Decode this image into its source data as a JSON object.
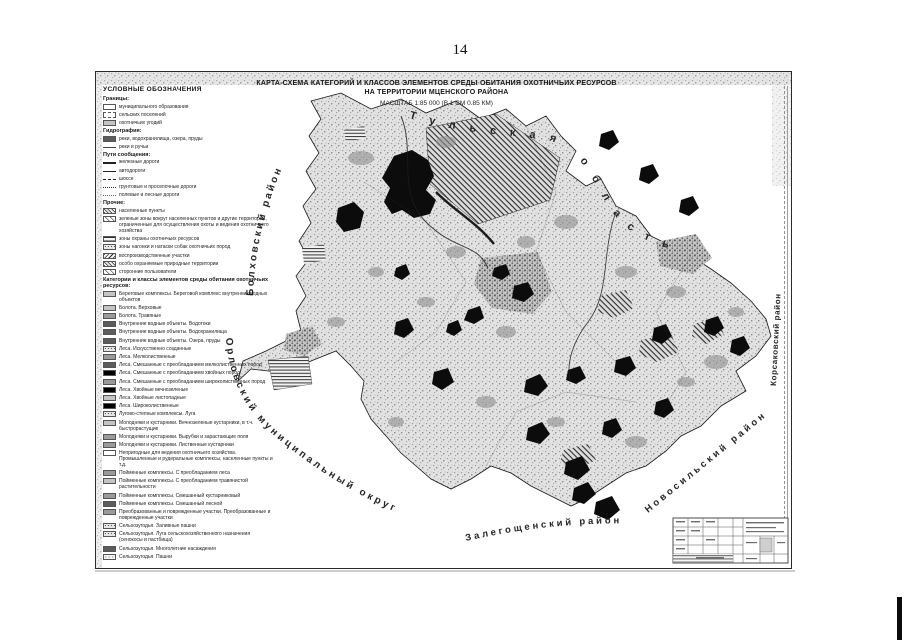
{
  "page": {
    "number": "14"
  },
  "map": {
    "title_line1": "КАРТА-СХЕМА КАТЕГОРИЙ И КЛАССОВ ЭЛЕМЕНТОВ СРЕДЫ ОБИТАНИЯ ОХОТНИЧЬИХ РЕСУРСОВ",
    "title_line2": "НА ТЕРРИТОРИИ МЦЕНСКОГО РАЙОНА",
    "scale_note": "МАСШТАБ 1:85 000 (В 1 СМ 0.85 КМ)",
    "region_labels": [
      "Тульская область",
      "Болховский район",
      "Орловский муниципальный округ",
      "Залегощенский район",
      "Новосильский район",
      "Корсаковский район"
    ]
  },
  "legend": {
    "title": "УСЛОВНЫЕ ОБОЗНАЧЕНИЯ",
    "sections": [
      {
        "header": "Границы:",
        "items": [
          {
            "label": "муниципального образования",
            "swatch": "sw-outline"
          },
          {
            "label": "сельских поселений",
            "swatch": "sw-outline-dash"
          },
          {
            "label": "охотничьих угодий",
            "swatch": "sw-gray-lt"
          }
        ]
      },
      {
        "header": "Гидрография:",
        "items": [
          {
            "label": "реки, водохранилища, озера, пруды",
            "swatch": "sw-dark"
          },
          {
            "label": "реки и ручьи",
            "swatch": "sw-line-thin"
          }
        ]
      },
      {
        "header": "Пути сообщения:",
        "items": [
          {
            "label": "железные дороги",
            "swatch": "sw-line-rail"
          },
          {
            "label": "автодороги",
            "swatch": "sw-line-solid"
          },
          {
            "label": "шоссе",
            "swatch": "sw-line-dash"
          },
          {
            "label": "грунтовые и проселочные дороги",
            "swatch": "sw-line-dashdot"
          },
          {
            "label": "полевые и лесные дороги",
            "swatch": "sw-line-dot"
          }
        ]
      },
      {
        "header": "Прочие:",
        "items": [
          {
            "label": "населенные пункты",
            "swatch": "sw-hatch"
          },
          {
            "label": "зеленые зоны вокруг населенных пунктов и другие территории, ограниченные для осуществления охоты и ведения охотничьего хозяйства",
            "swatch": "sw-hatch-sparse"
          },
          {
            "label": "зоны охраны охотничьих ресурсов",
            "swatch": "sw-hlines"
          },
          {
            "label": "зоны нагонки и натаски собак охотничьих пород",
            "swatch": "sw-speckle"
          },
          {
            "label": "воспроизводственные участки",
            "swatch": "sw-backhatch"
          },
          {
            "label": "особо охраняемые природные территории",
            "swatch": "sw-hatch"
          },
          {
            "label": "сторонние пользователи",
            "swatch": "sw-hatch-sparse"
          }
        ]
      },
      {
        "header": "Категории и классы элементов среды обитания охотничьих ресурсов:",
        "items": [
          {
            "label": "Береговые комплексы. Береговой комплекс внутренних водных объектов",
            "swatch": "sw-gray-lt"
          },
          {
            "label": "Болота. Верховые",
            "swatch": "sw-gray-lt"
          },
          {
            "label": "Болота. Травяные",
            "swatch": "sw-gray"
          },
          {
            "label": "Внутренние водные объекты. Водотоки",
            "swatch": "sw-dark"
          },
          {
            "label": "Внутренние водные объекты. Водохранилища",
            "swatch": "sw-dark"
          },
          {
            "label": "Внутренние водные объекты. Озера, пруды",
            "swatch": "sw-dark"
          },
          {
            "label": "Леса. Искусственно созданные",
            "swatch": "sw-speckle"
          },
          {
            "label": "Леса. Мелколиственные",
            "swatch": "sw-gray"
          },
          {
            "label": "Леса. Смешанные с преобладанием мелколиственных пород",
            "swatch": "sw-dark"
          },
          {
            "label": "Леса. Смешанные с преобладанием хвойных пород",
            "swatch": "sw-black"
          },
          {
            "label": "Леса. Смешанные с преобладанием широколиственных пород",
            "swatch": "sw-gray"
          },
          {
            "label": "Леса. Хвойные вечнозеленые",
            "swatch": "sw-black"
          },
          {
            "label": "Леса. Хвойные листопадные",
            "swatch": "sw-gray-lt"
          },
          {
            "label": "Леса. Широколиственные",
            "swatch": "sw-black"
          },
          {
            "label": "Лугово-степные комплексы. Луга",
            "swatch": "sw-speckle"
          },
          {
            "label": "Молодняки и кустарники. Вечнозеленые кустарники, в т.ч. быстрорастущие",
            "swatch": "sw-gray-lt"
          },
          {
            "label": "Молодняки и кустарники. Вырубки и зарастающие поля",
            "swatch": "sw-gray"
          },
          {
            "label": "Молодняки и кустарники. Лиственные кустарники",
            "swatch": "sw-gray"
          },
          {
            "label": "Непригодные для ведения охотничьего хозяйства. Промышленные и рудеральные комплексы, населенные пункты и т.д.",
            "swatch": "sw-outline"
          },
          {
            "label": "Пойменные комплексы. С преобладанием леса",
            "swatch": "sw-gray"
          },
          {
            "label": "Пойменные комплексы. С преобладанием травянистой растительности",
            "swatch": "sw-gray-lt"
          },
          {
            "label": "Пойменные комплексы. Смешанный кустарниковый",
            "swatch": "sw-gray"
          },
          {
            "label": "Пойменные комплексы. Смешанный лесной",
            "swatch": "sw-dark"
          },
          {
            "label": "Преобразованные и поврежденные участки. Преобразованные и поврежденные участки",
            "swatch": "sw-gray"
          },
          {
            "label": "Сельхозугодья. Заливные пашни",
            "swatch": "sw-speckle"
          },
          {
            "label": "Сельхозугодья. Луга сельскохозяйственного назначения (сенокосы и пастбища)",
            "swatch": "sw-speckle"
          },
          {
            "label": "Сельхозугодья. Многолетние насаждения",
            "swatch": "sw-dark"
          },
          {
            "label": "Сельхозугодья. Пашни",
            "swatch": "sw-speckle-lt"
          }
        ]
      }
    ]
  }
}
